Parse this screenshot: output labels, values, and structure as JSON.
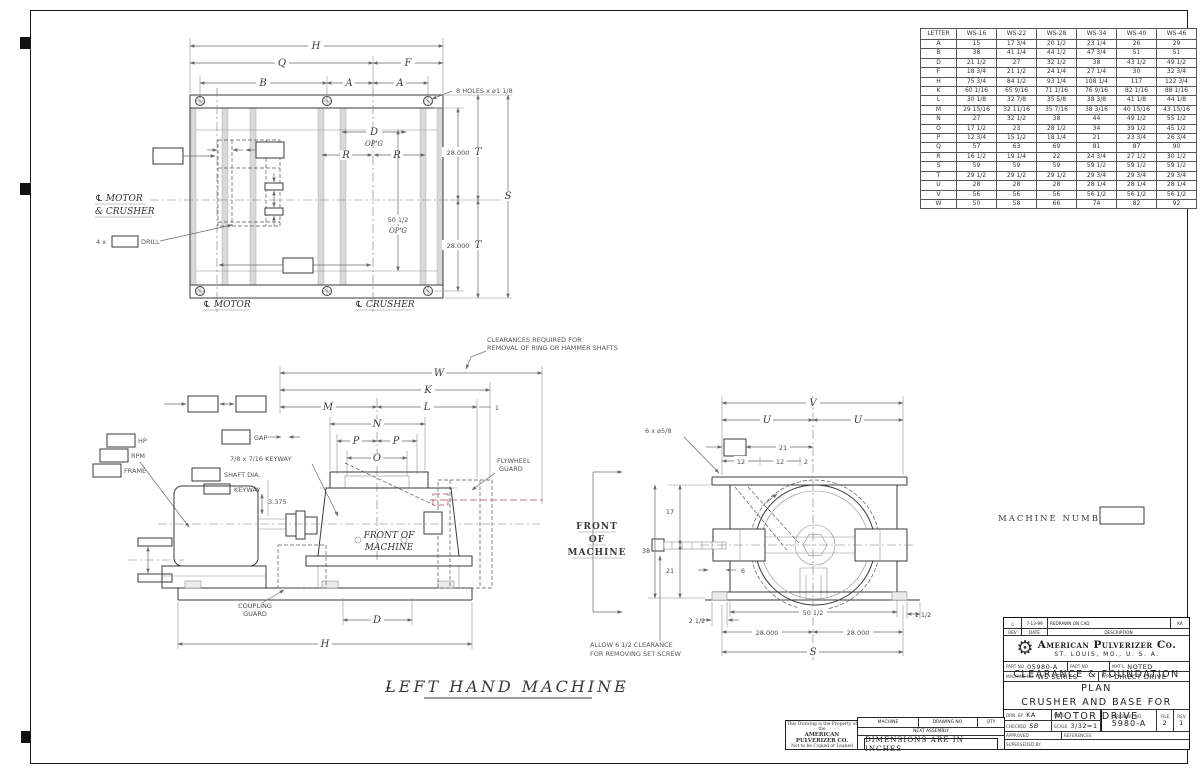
{
  "colors": {
    "line": "#3a3a3a",
    "dim": "#6a6a6a",
    "accent_red": "#c4717f",
    "paper": "#ffffff"
  },
  "dim_table": {
    "headers": [
      "LETTER",
      "WS-16",
      "WS-22",
      "WS-28",
      "WS-34",
      "WS-40",
      "WS-46"
    ],
    "rows": [
      [
        "A",
        "15",
        "17 3/4",
        "20 1/2",
        "23 1/4",
        "26",
        "29"
      ],
      [
        "B",
        "38",
        "41 1/4",
        "44 1/2",
        "47 3/4",
        "51",
        "51"
      ],
      [
        "D",
        "21 1/2",
        "27",
        "32 1/2",
        "38",
        "43 1/2",
        "49 1/2"
      ],
      [
        "F",
        "18 3/4",
        "21 1/2",
        "24 1/4",
        "27 1/4",
        "30",
        "32 3/4"
      ],
      [
        "H",
        "75 3/4",
        "84 1/2",
        "93 1/4",
        "108 1/4",
        "117",
        "122 3/4"
      ],
      [
        "K",
        "60 1/16",
        "65 9/16",
        "71 1/16",
        "76 9/16",
        "82 1/16",
        "88 1/16"
      ],
      [
        "L",
        "30 1/8",
        "32 7/8",
        "35 5/8",
        "38 3/8",
        "41 1/8",
        "44 1/8"
      ],
      [
        "M",
        "29 15/16",
        "32 11/16",
        "35 7/16",
        "38 3/16",
        "40 15/16",
        "43 15/16"
      ],
      [
        "N",
        "27",
        "32 1/2",
        "38",
        "44",
        "49 1/2",
        "55 1/2"
      ],
      [
        "O",
        "17 1/2",
        "23",
        "28 1/2",
        "34",
        "39 1/2",
        "45 1/2"
      ],
      [
        "P",
        "12 3/4",
        "15 1/2",
        "18 1/4",
        "21",
        "23 3/4",
        "26 3/4"
      ],
      [
        "Q",
        "57",
        "63",
        "69",
        "81",
        "87",
        "90"
      ],
      [
        "R",
        "16 1/2",
        "19 1/4",
        "22",
        "24 3/4",
        "27 1/2",
        "30 1/2"
      ],
      [
        "S",
        "59",
        "59",
        "59",
        "59 1/2",
        "59 1/2",
        "59 1/2"
      ],
      [
        "T",
        "29 1/2",
        "29 1/2",
        "29 1/2",
        "29 3/4",
        "29 3/4",
        "29 3/4"
      ],
      [
        "U",
        "28",
        "28",
        "28",
        "28 1/4",
        "28 1/4",
        "28 1/4"
      ],
      [
        "V",
        "56",
        "56",
        "56",
        "56 1/2",
        "56 1/2",
        "56 1/2"
      ],
      [
        "W",
        "50",
        "58",
        "66",
        "74",
        "82",
        "92"
      ]
    ]
  },
  "plan": {
    "h": "H",
    "q": "Q",
    "f": "F",
    "b": "B",
    "a1": "A",
    "a2": "A",
    "holes_note": "8 HOLES x ⌀1 1/8",
    "d": "D",
    "opg1": "OP'G",
    "r1": "R",
    "r2": "R",
    "n28a": "28.000",
    "t1": "T",
    "n28b": "28.000",
    "t2": "T",
    "s": "S",
    "opening": "50 1/2",
    "opg2": "OP'G",
    "cl_mc1": "℄ MOTOR",
    "cl_mc2": "& CRUSHER",
    "drill_prefix": "4 x",
    "drill": "DRILL",
    "cl_motor": "℄ MOTOR",
    "cl_crusher": "℄ CRUSHER"
  },
  "elev": {
    "note1": "CLEARANCES REQUIRED FOR",
    "note2": "REMOVAL OF RING OR HAMMER SHAFTS",
    "w": "W",
    "k": "K",
    "m": "M",
    "l": "L",
    "one": "1",
    "n": "N",
    "p1": "P",
    "p2": "P",
    "o": "O",
    "gap": "GAP",
    "keyway_note": "7/8 x 7/16 KEYWAY",
    "shaft1": "SHAFT DIA.",
    "shaft2": "KEYWAY",
    "n3375": "3.375",
    "hp": "HP",
    "rpm": "RPM",
    "frame": "FRAME",
    "fly1": "FLYWHEEL",
    "fly2": "GUARD",
    "front1": "FRONT OF",
    "front2": "MACHINE",
    "coup1": "COUPLING",
    "coup2": "GUARD",
    "d": "D",
    "h": "H"
  },
  "end_view": {
    "v": "V",
    "u1": "U",
    "u2": "U",
    "holes_note": "6 x ⌀5/8",
    "n21top": "21",
    "n12a": "12",
    "n12b": "12",
    "n2": "2",
    "n17": "17",
    "n38": "38",
    "n21": "21",
    "n6": "6",
    "n2half": "2 1/2",
    "n50half": "50 1/2",
    "n1half": "1 1/2",
    "n28a": "28.000",
    "n28b": "28.000",
    "s": "S",
    "note1": "ALLOW 6 1/2 CLEARANCE",
    "note2": "FOR REMOVING SET SCREW"
  },
  "front_label": {
    "l1": "FRONT",
    "l2": "OF",
    "l3": "MACHINE"
  },
  "machine_number": {
    "label": "MACHINE  NUMBER"
  },
  "main_title": {
    "dash1": "-",
    "text": "LEFT  HAND  MACHINE",
    "dash2": "-"
  },
  "title_block": {
    "rev_marker": "△",
    "rev_date": "7-13-99",
    "rev_desc": "REDRAWN ON CAD",
    "rev_by": "KA",
    "col_rev": "REV",
    "col_date": "DATE",
    "col_desc": "DESCRIPTION",
    "gear_icon": "⚙",
    "company": "American Pulverizer Co.",
    "address": "ST. LOUIS, MO., U. S. A.",
    "part_label": "PART NO",
    "part_value": "05980-A",
    "part2_label": "PART NO",
    "matl_label": "MAT'L",
    "matl_value": "NOTED",
    "machine_label": "MACHINE NO.",
    "machine_value": "WS SERIES",
    "type_label": "TYPE",
    "type_value": "DIRECT DRIVE",
    "title1": "CLEARANCE & FOUNDATION PLAN",
    "title2": "CRUSHER AND BASE FOR MOTOR DRIVE",
    "drn_label": "DRN. BY",
    "drn_value": "KA",
    "date_label": "DATE",
    "checked_label": "CHECKED",
    "checked_value": "SB",
    "scale_label": "SCALE",
    "scale_value": "3/32=1",
    "approved_label": "APPROVED",
    "references_label": "REFERENCES",
    "superseded_label": "SUPERSEDED BY.",
    "dwg_label": "DRAWING NO.",
    "dwg_value": "5980-A",
    "file_label": "FILE",
    "file_value": "2",
    "rev_col_label": "REV",
    "rev_value": "1"
  },
  "bottom_strip": {
    "prop1": "This Drawing is the Property of the",
    "prop2": "AMERICAN PULVERIZER CO.",
    "prop3": "Not to be Copied or Loaned",
    "machine": "MACHINE",
    "drawing_no": "DRAWING NO.",
    "qty": "QTY",
    "next_assembly": "NEXT ASSEMBLY",
    "dims_note": "DIMENSIONS ARE IN INCHES"
  }
}
